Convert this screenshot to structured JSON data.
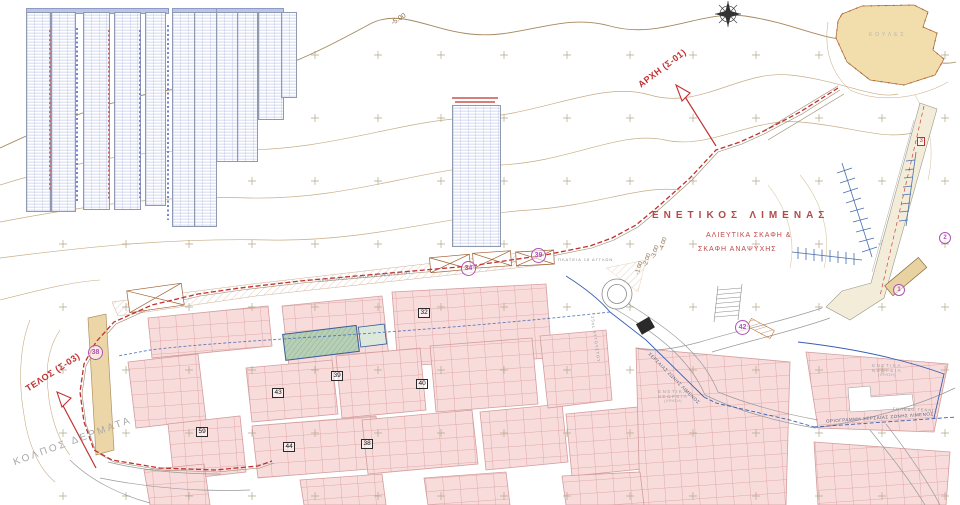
{
  "labels": {
    "harbor_title": "ΕΝΕΤΙΚΟΣ ΛΙΜΕΝΑΣ",
    "harbor_sub1": "ΑΛΙΕΥΤΙΚΑ ΣΚΑΦΗ &",
    "harbor_sub2": "ΣΚΑΦΗ ΑΝΑΨΥΧΗΣ",
    "fortress": "ΚΟΥΛΕΣ",
    "bay": "ΚΟΛΠΟΣ ΔΕΡΜΑΤΑ",
    "survey_start": "ΑΡΧΗ (Σ-01)",
    "survey_end": "ΤΕΛΟΣ (Σ-03)",
    "boundary_line": "ΟΡΙΟΓΡΑΜΜΗ ΧΕΡΣΑΙΑΣ ΖΩΝΗΣ ΛΙΜΕΝΟΣ",
    "boundary_line_diagonal": "ΧΕΡΣΑΙΑΣ ΖΩΝΗΣ ΛΙΜΕΝΟΣ",
    "tennis": "ΓΗΠΕΔΟ ΤΕΝΝΙΣ",
    "neoria_center": [
      "ΕΝΕΤΙΚΑ",
      "ΝΕΩΡΕΙΑ",
      "(ΧΡΗΣΗ)"
    ],
    "neoria_right": [
      "ΕΝΕΤΙΚΑ",
      "ΝΕΩΡΕΙΑ",
      "(ΧΡΗΣΗ)"
    ]
  },
  "contour_labels": {
    "offshore": "-5.00",
    "harbor": [
      "-4.00",
      "-3.00",
      "-2.00",
      "-1.00"
    ]
  },
  "streets": {
    "coastal": "ΛΕΩΦΟΡΟΣ ΣΟΦΟΚΛΗ ΒΕΝΙΖΕΛΟΥ",
    "main": "25ης ΑΥΓΟΥΣΤΟΥ",
    "square": "ΠΛΑΤΕΙΑ 18 ΑΓΓΛΩΝ"
  },
  "area_markers": [
    {
      "label": "34"
    },
    {
      "label": "39"
    },
    {
      "label": "38"
    },
    {
      "label": "42"
    },
    {
      "label": "1"
    },
    {
      "label": "2"
    },
    {
      "label": "3"
    }
  ],
  "block_numbers": [
    {
      "label": "32"
    },
    {
      "label": "43"
    },
    {
      "label": "39"
    },
    {
      "label": "40"
    },
    {
      "label": "59"
    },
    {
      "label": "44"
    },
    {
      "label": "38"
    }
  ],
  "colors": {
    "survey_red": "#c23030",
    "marker_magenta": "#b050b8",
    "contour_tan": "#c7ad85",
    "block_pink": "#f8dcdc",
    "fortress_tan": "#f2deac",
    "pier_blue": "#4a6fae",
    "boundary_blue": "#3a5fb0"
  }
}
